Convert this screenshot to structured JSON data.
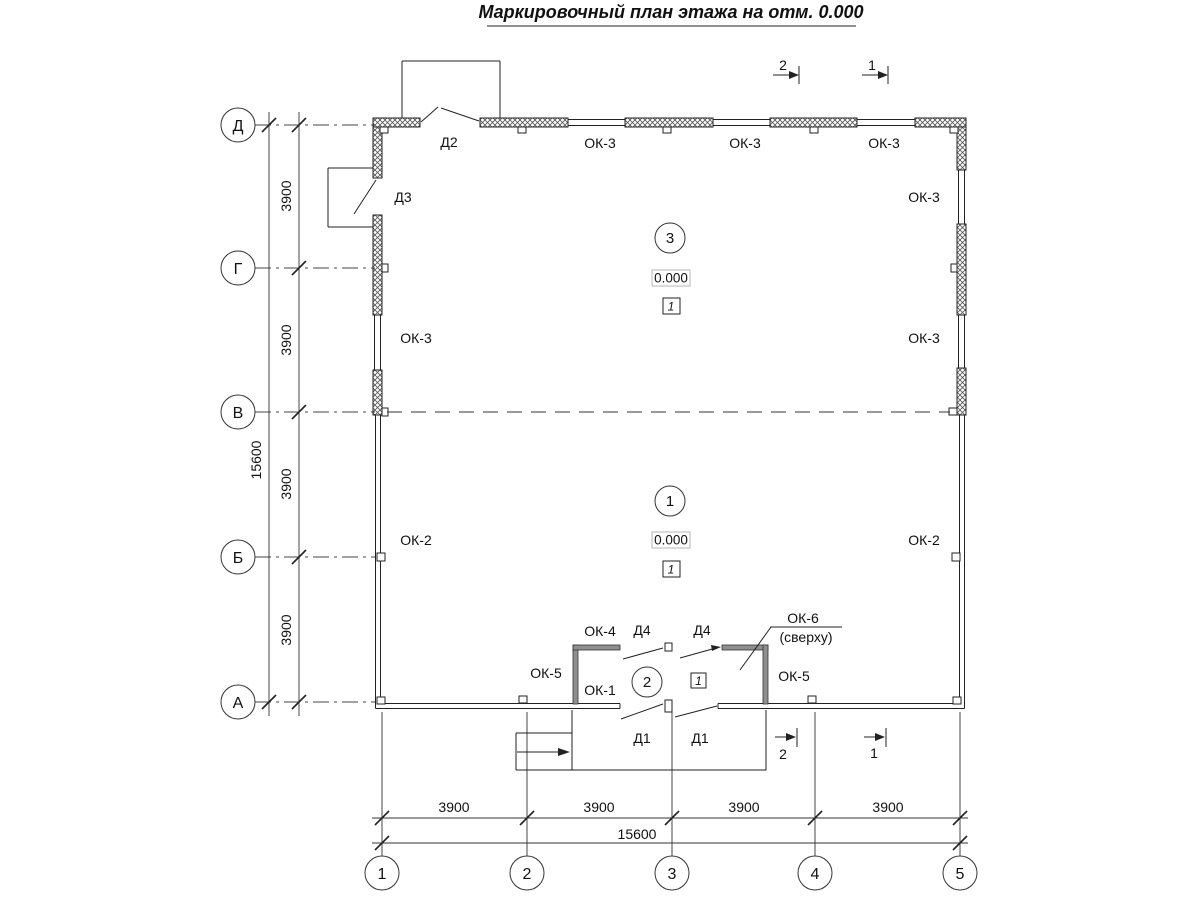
{
  "title": "Маркировочный план этажа на отм. 0.000",
  "axis_rows": [
    "Д",
    "Г",
    "В",
    "Б",
    "А"
  ],
  "axis_cols": [
    "1",
    "2",
    "3",
    "4",
    "5"
  ],
  "dims": {
    "bay": "3900",
    "total": "15600"
  },
  "windows": {
    "ok1": "ОК-1",
    "ok2": "ОК-2",
    "ok3": "ОК-3",
    "ok4": "ОК-4",
    "ok5": "ОК-5",
    "ok6": "ОК-6",
    "ok6_note": "(сверху)"
  },
  "doors": {
    "d1": "Д1",
    "d2": "Д2",
    "d3": "Д3",
    "d4": "Д4"
  },
  "rooms": [
    {
      "num": "3",
      "elev": "0.000",
      "floor": "1"
    },
    {
      "num": "1",
      "elev": "0.000",
      "floor": "1"
    },
    {
      "num": "2",
      "floor": "1"
    }
  ],
  "sections": {
    "s1": "1",
    "s2": "2"
  }
}
